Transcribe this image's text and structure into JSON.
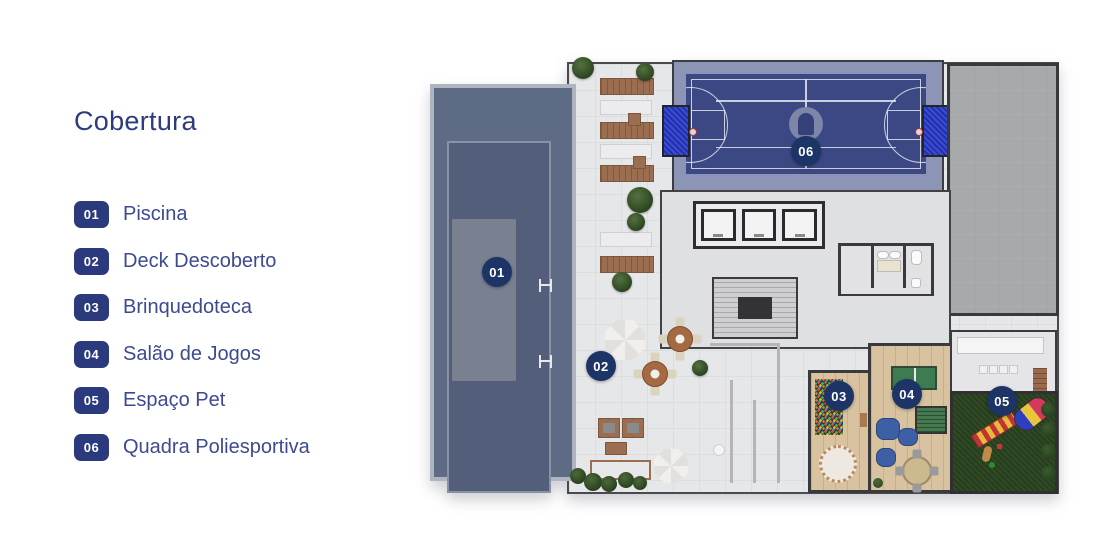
{
  "title": "Cobertura",
  "legend": {
    "items": [
      {
        "num": "01",
        "label": "Piscina"
      },
      {
        "num": "02",
        "label": "Deck Descoberto"
      },
      {
        "num": "03",
        "label": "Brinquedoteca"
      },
      {
        "num": "04",
        "label": "Salão de Jogos"
      },
      {
        "num": "05",
        "label": "Espaço Pet"
      },
      {
        "num": "06",
        "label": "Quadra Poliesportiva"
      }
    ]
  },
  "plan": {
    "markers": [
      {
        "num": "01",
        "area": "piscina"
      },
      {
        "num": "02",
        "area": "deck-descoberto"
      },
      {
        "num": "03",
        "area": "brinquedoteca"
      },
      {
        "num": "04",
        "area": "salao-de-jogos"
      },
      {
        "num": "05",
        "area": "espaco-pet"
      },
      {
        "num": "06",
        "area": "quadra-poliesportiva"
      }
    ]
  },
  "colors": {
    "title_navy": "#2d3c7c",
    "label_navy": "#3d4a92",
    "legend_badge_navy": "#2b3a7c",
    "marker_navy": "#1d3566",
    "pool_deck_slate": "#5d6b85",
    "pool_water": "#535f7a",
    "court_blue": "#3c4883",
    "court_band": "#8c95b5",
    "deck_gray": "#e6e7e9",
    "concrete_gray": "#a8a9ab",
    "wood_floor": "#d8c29f",
    "grass_green": "#2f4a24"
  }
}
